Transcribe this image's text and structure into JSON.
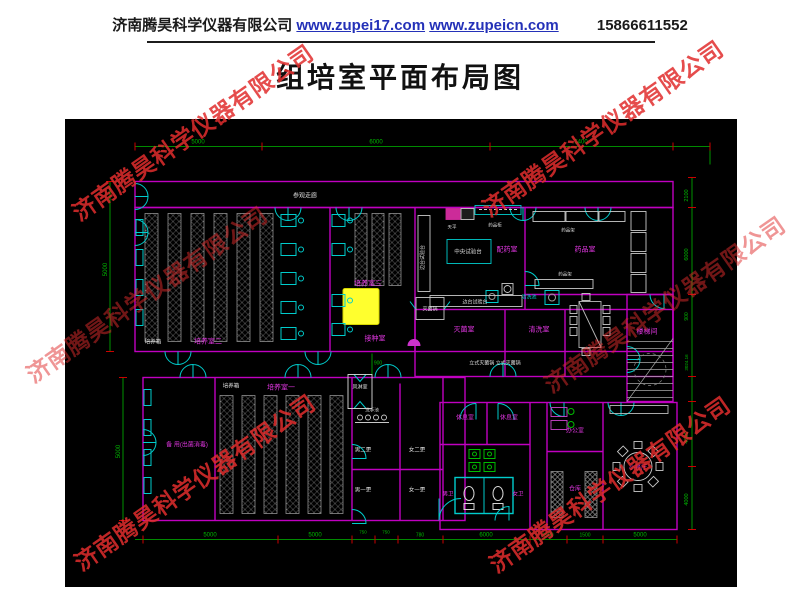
{
  "header": {
    "company": "济南腾昊科学仪器有限公司",
    "url1": "www.zupei17.com",
    "url2": "www.zupeicn.com",
    "phone": "15866611552"
  },
  "title": "组培室平面布局图",
  "watermark": {
    "text": "济南腾昊科学仪器有限公司",
    "color": "#e12d2d",
    "instances": [
      {
        "left": 48,
        "top": 114,
        "opacity": 0.85
      },
      {
        "left": 458,
        "top": 110,
        "opacity": 0.85
      },
      {
        "left": 2,
        "top": 276,
        "opacity": 0.5
      },
      {
        "left": 520,
        "top": 286,
        "opacity": 0.5
      },
      {
        "left": 50,
        "top": 464,
        "opacity": 0.85
      },
      {
        "left": 465,
        "top": 466,
        "opacity": 0.85
      }
    ]
  },
  "floorplan": {
    "colors": {
      "background": "#000000",
      "wall": "#c000c0",
      "door": "#00cccc",
      "dimension": "#00b800",
      "tick": "#cc0000",
      "furniture": "#c8c8c8",
      "rack": "#8f8f8f",
      "highlight": "#ffff2e",
      "room_label": "#e036e0",
      "note_label": "#dcdcdc",
      "cyan_label": "#00d2d2"
    },
    "labels": [
      {
        "text": "参观走廊",
        "x": 240,
        "y": 78,
        "color": "#dcdcdc",
        "size": 6
      },
      {
        "text": "培养室二",
        "x": 143,
        "y": 224,
        "color": "#e036e0",
        "size": 7
      },
      {
        "text": "培养箱",
        "x": 88,
        "y": 224,
        "color": "#dcdcdc",
        "size": 5.5
      },
      {
        "text": "培养室三",
        "x": 303,
        "y": 166,
        "color": "#e036e0",
        "size": 7
      },
      {
        "text": "接种室",
        "x": 310,
        "y": 221,
        "color": "#e036e0",
        "size": 7
      },
      {
        "text": "配药室",
        "x": 442,
        "y": 132,
        "color": "#e036e0",
        "size": 7
      },
      {
        "text": "药品室",
        "x": 520,
        "y": 132,
        "color": "#e036e0",
        "size": 7
      },
      {
        "text": "灭菌室",
        "x": 399,
        "y": 212,
        "color": "#e036e0",
        "size": 7
      },
      {
        "text": "清洗室",
        "x": 474,
        "y": 212,
        "color": "#e036e0",
        "size": 7
      },
      {
        "text": "楼梯间",
        "x": 582,
        "y": 214,
        "color": "#e036e0",
        "size": 7
      },
      {
        "text": "培养室一",
        "x": 216,
        "y": 270,
        "color": "#e036e0",
        "size": 7
      },
      {
        "text": "培养箱",
        "x": 166,
        "y": 268,
        "color": "#dcdcdc",
        "size": 5.5
      },
      {
        "text": "备 用(出菌消毒)",
        "x": 122,
        "y": 327,
        "color": "#e036e0",
        "size": 6
      },
      {
        "text": "休息室",
        "x": 400,
        "y": 300,
        "color": "#e036e0",
        "size": 6
      },
      {
        "text": "休息室",
        "x": 444,
        "y": 300,
        "color": "#e036e0",
        "size": 6
      },
      {
        "text": "办公室",
        "x": 510,
        "y": 313,
        "color": "#e036e0",
        "size": 6
      },
      {
        "text": "仓库",
        "x": 510,
        "y": 371,
        "color": "#e036e0",
        "size": 6
      },
      {
        "text": "小餐厅",
        "x": 573,
        "y": 350,
        "color": "#e036e0",
        "size": 6
      },
      {
        "text": "男卫",
        "x": 383,
        "y": 376,
        "color": "#e036e0",
        "size": 5.5
      },
      {
        "text": "女卫",
        "x": 453,
        "y": 376,
        "color": "#e036e0",
        "size": 5.5
      },
      {
        "text": "男二更",
        "x": 298,
        "y": 332,
        "color": "#dcdcdc",
        "size": 5.5
      },
      {
        "text": "女二更",
        "x": 352,
        "y": 332,
        "color": "#dcdcdc",
        "size": 5.5
      },
      {
        "text": "男一更",
        "x": 298,
        "y": 372,
        "color": "#dcdcdc",
        "size": 5.5
      },
      {
        "text": "女一更",
        "x": 352,
        "y": 372,
        "color": "#dcdcdc",
        "size": 5.5
      },
      {
        "text": "中央试验台",
        "x": 403,
        "y": 134,
        "color": "#dcdcdc",
        "size": 5.5
      },
      {
        "text": "边台试验台",
        "x": 410,
        "y": 184,
        "color": "#dcdcdc",
        "size": 5
      },
      {
        "text": "边台试验台",
        "x": 359,
        "y": 138,
        "color": "#dcdcdc",
        "size": 5,
        "rot": -90
      },
      {
        "text": "天平",
        "x": 387,
        "y": 109,
        "color": "#dcdcdc",
        "size": 4.5
      },
      {
        "text": "药品柜",
        "x": 430,
        "y": 107,
        "color": "#dcdcdc",
        "size": 4.5
      },
      {
        "text": "药品架",
        "x": 503,
        "y": 112,
        "color": "#dcdcdc",
        "size": 4.5
      },
      {
        "text": "药品架",
        "x": 500,
        "y": 156,
        "color": "#dcdcdc",
        "size": 4.5
      },
      {
        "text": "灭菌锅",
        "x": 365,
        "y": 191,
        "color": "#dcdcdc",
        "size": 5
      },
      {
        "text": "立式灭菌锅 立式灭菌锅",
        "x": 430,
        "y": 245,
        "color": "#dcdcdc",
        "size": 5
      },
      {
        "text": "风淋室",
        "x": 295,
        "y": 269,
        "color": "#dcdcdc",
        "size": 5
      },
      {
        "text": "洗手池",
        "x": 307,
        "y": 292,
        "color": "#dcdcdc",
        "size": 4.5
      },
      {
        "text": "清洗池",
        "x": 464,
        "y": 179,
        "color": "#00d2d2",
        "size": 5
      },
      {
        "text": "5000",
        "x": 133,
        "y": 24,
        "color": "#00b800",
        "size": 6
      },
      {
        "text": "6000",
        "x": 311,
        "y": 24,
        "color": "#00b800",
        "size": 6
      },
      {
        "text": "5400",
        "x": 516,
        "y": 24,
        "color": "#00b800",
        "size": 6
      },
      {
        "text": "5000",
        "x": 42,
        "y": 150,
        "color": "#00b800",
        "size": 6,
        "rot": -90
      },
      {
        "text": "5000",
        "x": 55,
        "y": 332,
        "color": "#00b800",
        "size": 6,
        "rot": -90
      },
      {
        "text": "2100",
        "x": 623,
        "y": 76,
        "color": "#00b800",
        "size": 5.5,
        "rot": -90
      },
      {
        "text": "6000",
        "x": 623,
        "y": 135,
        "color": "#00b800",
        "size": 5.5,
        "rot": -90
      },
      {
        "text": "900",
        "x": 623,
        "y": 197,
        "color": "#00b800",
        "size": 5,
        "rot": -90
      },
      {
        "text": "3024.16",
        "x": 623,
        "y": 243,
        "color": "#00b800",
        "size": 4.5,
        "rot": -90
      },
      {
        "text": "4000",
        "x": 623,
        "y": 318,
        "color": "#00b800",
        "size": 5.5,
        "rot": -90
      },
      {
        "text": "4000",
        "x": 623,
        "y": 380,
        "color": "#00b800",
        "size": 5.5,
        "rot": -90
      },
      {
        "text": "5000",
        "x": 145,
        "y": 417,
        "color": "#00b800",
        "size": 6
      },
      {
        "text": "5000",
        "x": 250,
        "y": 417,
        "color": "#00b800",
        "size": 6
      },
      {
        "text": "750",
        "x": 298,
        "y": 414,
        "color": "#00b800",
        "size": 4.5
      },
      {
        "text": "750",
        "x": 321,
        "y": 414,
        "color": "#00b800",
        "size": 4.5
      },
      {
        "text": "780",
        "x": 355,
        "y": 417,
        "color": "#00b800",
        "size": 5
      },
      {
        "text": "6000",
        "x": 421,
        "y": 417,
        "color": "#00b800",
        "size": 6
      },
      {
        "text": "1500",
        "x": 483,
        "y": 417,
        "color": "#00b800",
        "size": 5
      },
      {
        "text": "1500",
        "x": 520,
        "y": 417,
        "color": "#00b800",
        "size": 5
      },
      {
        "text": "5000",
        "x": 575,
        "y": 417,
        "color": "#00b800",
        "size": 6
      },
      {
        "text": "900",
        "x": 313,
        "y": 245,
        "color": "#00b800",
        "size": 5
      }
    ]
  }
}
